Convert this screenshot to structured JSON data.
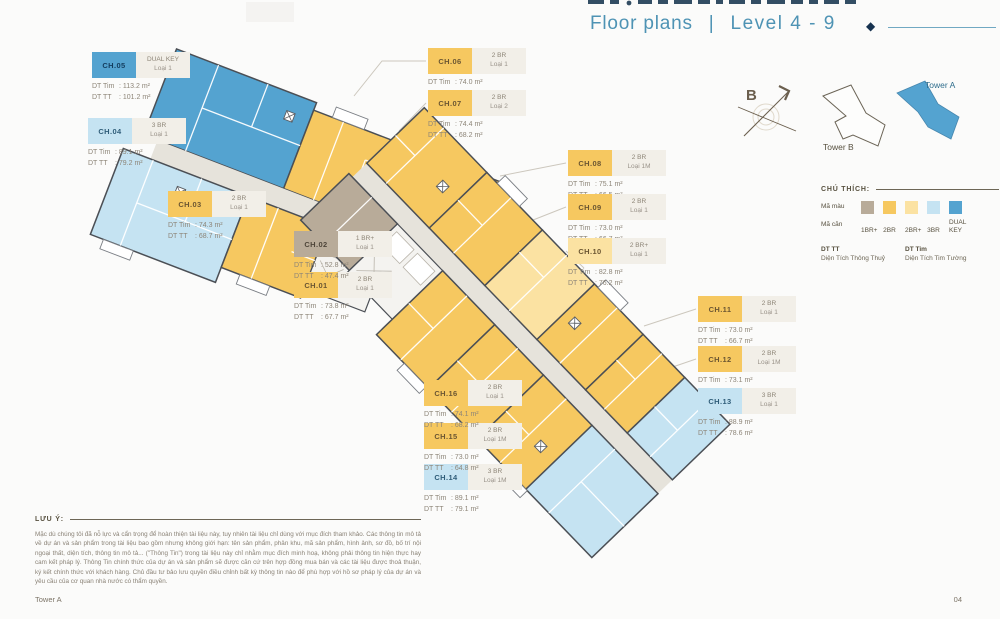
{
  "header": {
    "title": "Floor plans",
    "divider": "|",
    "level": "Level 4 - 9"
  },
  "labels": {
    "dt_tim": "DT Tim",
    "dt_tt": "DT TT"
  },
  "units": [
    {
      "id": "CH.01",
      "type": "2 BR",
      "variant": "Loại 1",
      "dt_tim": "73.8 m²",
      "dt_tt": "67.7 m²",
      "color_key": "2br"
    },
    {
      "id": "CH.02",
      "type": "1 BR+",
      "variant": "Loại 1",
      "dt_tim": "52.8 m²",
      "dt_tt": "47.4 m²",
      "color_key": "1br_plus"
    },
    {
      "id": "CH.03",
      "type": "2 BR",
      "variant": "Loại 1",
      "dt_tim": "74.3 m²",
      "dt_tt": "68.7 m²",
      "color_key": "2br"
    },
    {
      "id": "CH.04",
      "type": "3 BR",
      "variant": "Loại 1",
      "dt_tim": "89.1 m²",
      "dt_tt": "79.2 m²",
      "color_key": "3br"
    },
    {
      "id": "CH.05",
      "type": "DUAL KEY",
      "variant": "Loại 1",
      "dt_tim": "113.2 m²",
      "dt_tt": "101.2 m²",
      "color_key": "dual_key"
    },
    {
      "id": "CH.06",
      "type": "2 BR",
      "variant": "Loại 1",
      "dt_tim": "74.0 m²",
      "dt_tt": "68.0 m²",
      "color_key": "2br"
    },
    {
      "id": "CH.07",
      "type": "2 BR",
      "variant": "Loại 2",
      "dt_tim": "74.4 m²",
      "dt_tt": "68.2 m²",
      "color_key": "2br"
    },
    {
      "id": "CH.08",
      "type": "2 BR",
      "variant": "Loại 1M",
      "dt_tim": "75.1 m²",
      "dt_tt": "66.5 m²",
      "color_key": "2br"
    },
    {
      "id": "CH.09",
      "type": "2 BR",
      "variant": "Loại 1",
      "dt_tim": "73.0 m²",
      "dt_tt": "66.7 m²",
      "color_key": "2br"
    },
    {
      "id": "CH.10",
      "type": "2 BR+",
      "variant": "Loại 1",
      "dt_tim": "82.8 m²",
      "dt_tt": "76.2 m²",
      "color_key": "2br_plus"
    },
    {
      "id": "CH.11",
      "type": "2 BR",
      "variant": "Loại 1",
      "dt_tim": "73.0 m²",
      "dt_tt": "66.7 m²",
      "color_key": "2br"
    },
    {
      "id": "CH.12",
      "type": "2 BR",
      "variant": "Loại 1M",
      "dt_tim": "73.1 m²",
      "dt_tt": "67.0 m²",
      "color_key": "2br"
    },
    {
      "id": "CH.13",
      "type": "3 BR",
      "variant": "Loại 1",
      "dt_tim": "88.9 m²",
      "dt_tt": "78.6 m²",
      "color_key": "3br"
    },
    {
      "id": "CH.14",
      "type": "3 BR",
      "variant": "Loại 1M",
      "dt_tim": "89.1 m²",
      "dt_tt": "79.1 m²",
      "color_key": "3br"
    },
    {
      "id": "CH.15",
      "type": "2 BR",
      "variant": "Loại 1M",
      "dt_tim": "73.0 m²",
      "dt_tt": "64.8 m²",
      "color_key": "2br"
    },
    {
      "id": "CH.16",
      "type": "2 BR",
      "variant": "Loại 1",
      "dt_tim": "74.1 m²",
      "dt_tt": "68.2 m²",
      "color_key": "2br"
    }
  ],
  "legend": {
    "title": "CHÚ THÍCH:",
    "color_row_label": "Mã màu",
    "code_row_label": "Mã căn",
    "items": [
      {
        "code": "1BR+",
        "color_key": "1br_plus"
      },
      {
        "code": "2BR",
        "color_key": "2br"
      },
      {
        "code": "2BR+",
        "color_key": "2br_plus"
      },
      {
        "code": "3BR",
        "color_key": "3br"
      },
      {
        "code": "DUAL KEY",
        "color_key": "dual_key"
      }
    ],
    "dt_tt_label": "DT TT",
    "dt_tt_desc": "Diện Tích Thông Thuỷ",
    "dt_tim_label": "DT Tim",
    "dt_tim_desc": "Diện Tích Tim Tường"
  },
  "keyplan": {
    "tower_a": "Tower A",
    "tower_b": "Tower B",
    "compass_label": "B"
  },
  "note": {
    "label": "LƯU Ý:",
    "text": "Mặc dù chúng tôi đã nỗ lực và cẩn trọng để hoàn thiện tài liệu này, tuy nhiên tài liệu chỉ dùng với mục đích tham khảo. Các thông tin mô tả về dự án và sản phẩm trong tài liệu bao gồm nhưng không giới hạn: tên sản phẩm, phân khu, mã sản phẩm, hình ảnh, sơ đồ, bố trí nội ngoại thất, diện tích, thông tin mô tả... (\"Thông Tin\") trong tài liệu này chỉ nhằm mục đích minh hoạ, không phải thông tin hiện thực hay cam kết pháp lý. Thông Tin chính thức của dự án và sản phẩm sẽ được căn cứ trên hợp đồng mua bán và các tài liệu được thoả thuận, ký kết chính thức với khách hàng. Chủ đầu tư bảo lưu quyền điều chỉnh bất kỳ thông tin nào để phù hợp với hồ sơ pháp lý của dự án và yêu cầu của cơ quan nhà nước có thẩm quyền."
  },
  "footer": {
    "left": "Tower A",
    "right": "04"
  },
  "palette": {
    "1br_plus": "#b8ab99",
    "2br": "#f6c860",
    "2br_plus": "#fbe2a2",
    "3br": "#c5e3f2",
    "dual_key": "#54a3d0",
    "corridor": "#e6e3db",
    "accent_blue": "#4e93b4",
    "navy": "#1d3b53",
    "outline": "#4b4f55"
  }
}
